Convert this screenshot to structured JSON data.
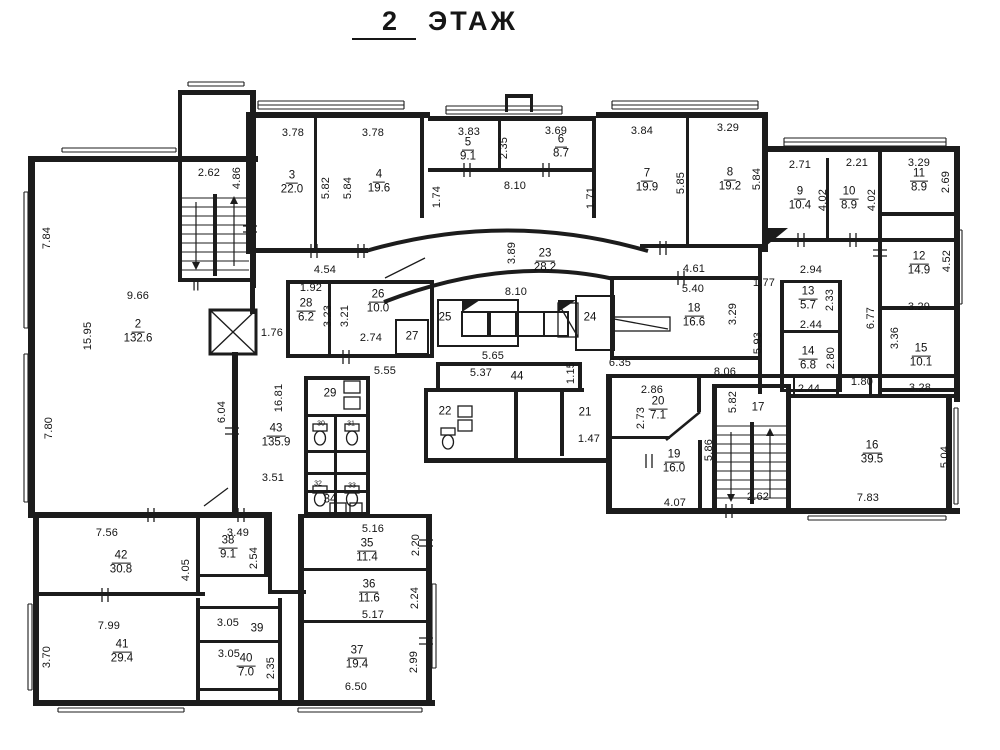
{
  "title": {
    "number": "2",
    "word": "ЭТАЖ"
  },
  "colors": {
    "ink": "#1c1c1c",
    "paper": "#ffffff"
  },
  "stair_mark": {
    "t": "II",
    "x": 196,
    "y": 286
  },
  "rooms": [
    {
      "n": "2",
      "a": "132.6",
      "x": 138,
      "y": 332
    },
    {
      "n": "3",
      "a": "22.0",
      "x": 292,
      "y": 183
    },
    {
      "n": "4",
      "a": "19.6",
      "x": 379,
      "y": 182
    },
    {
      "n": "5",
      "a": "9.1",
      "x": 468,
      "y": 150
    },
    {
      "n": "6",
      "a": "8.7",
      "x": 561,
      "y": 147
    },
    {
      "n": "7",
      "a": "19.9",
      "x": 647,
      "y": 181
    },
    {
      "n": "8",
      "a": "19.2",
      "x": 730,
      "y": 180
    },
    {
      "n": "9",
      "a": "10.4",
      "x": 800,
      "y": 199
    },
    {
      "n": "10",
      "a": "8.9",
      "x": 849,
      "y": 199
    },
    {
      "n": "11",
      "a": "8.9",
      "x": 919,
      "y": 181
    },
    {
      "n": "12",
      "a": "14.9",
      "x": 919,
      "y": 264
    },
    {
      "n": "13",
      "a": "5.7",
      "x": 808,
      "y": 299
    },
    {
      "n": "14",
      "a": "6.8",
      "x": 808,
      "y": 359
    },
    {
      "n": "15",
      "a": "10.1",
      "x": 921,
      "y": 356
    },
    {
      "n": "16",
      "a": "39.5",
      "x": 872,
      "y": 453
    },
    {
      "n": "17",
      "x": 758,
      "y": 408
    },
    {
      "n": "18",
      "a": "16.6",
      "x": 694,
      "y": 316
    },
    {
      "n": "19",
      "a": "16.0",
      "x": 674,
      "y": 462
    },
    {
      "n": "20",
      "a": "7.1",
      "x": 658,
      "y": 409
    },
    {
      "n": "21",
      "x": 585,
      "y": 413
    },
    {
      "n": "22",
      "x": 445,
      "y": 412
    },
    {
      "n": "23",
      "a": "28.2",
      "x": 545,
      "y": 261
    },
    {
      "n": "24",
      "x": 590,
      "y": 318
    },
    {
      "n": "25",
      "x": 445,
      "y": 318
    },
    {
      "n": "26",
      "a": "10.0",
      "x": 378,
      "y": 302
    },
    {
      "n": "27",
      "x": 412,
      "y": 337
    },
    {
      "n": "28",
      "a": "6.2",
      "x": 306,
      "y": 311
    },
    {
      "n": "29",
      "x": 330,
      "y": 394
    },
    {
      "n": "30",
      "x": 321,
      "y": 424,
      "tiny": 1
    },
    {
      "n": "31",
      "x": 351,
      "y": 424,
      "tiny": 1
    },
    {
      "n": "32",
      "x": 318,
      "y": 484,
      "tiny": 1
    },
    {
      "n": "33",
      "x": 352,
      "y": 486,
      "tiny": 1
    },
    {
      "n": "34",
      "x": 330,
      "y": 500
    },
    {
      "n": "35",
      "a": "11.4",
      "x": 367,
      "y": 551
    },
    {
      "n": "36",
      "a": "11.6",
      "x": 369,
      "y": 592
    },
    {
      "n": "37",
      "a": "19.4",
      "x": 357,
      "y": 658
    },
    {
      "n": "38",
      "a": "9.1",
      "x": 228,
      "y": 548
    },
    {
      "n": "39",
      "x": 257,
      "y": 629
    },
    {
      "n": "40",
      "a": "7.0",
      "x": 246,
      "y": 666
    },
    {
      "n": "41",
      "a": "29.4",
      "x": 122,
      "y": 652
    },
    {
      "n": "42",
      "a": "30.8",
      "x": 121,
      "y": 563
    },
    {
      "n": "43",
      "a": "135.9",
      "x": 276,
      "y": 436
    },
    {
      "n": "44",
      "x": 517,
      "y": 377
    }
  ],
  "dimensions": [
    {
      "t": "2.62",
      "x": 209,
      "y": 173
    },
    {
      "t": "4.86",
      "x": 237,
      "y": 178,
      "v": 1
    },
    {
      "t": "3.78",
      "x": 293,
      "y": 133
    },
    {
      "t": "3.78",
      "x": 373,
      "y": 133
    },
    {
      "t": "5.82",
      "x": 326,
      "y": 188,
      "v": 1
    },
    {
      "t": "5.84",
      "x": 348,
      "y": 188,
      "v": 1
    },
    {
      "t": "3.83",
      "x": 469,
      "y": 132
    },
    {
      "t": "2.35",
      "x": 504,
      "y": 148,
      "v": 1
    },
    {
      "t": "3.69",
      "x": 556,
      "y": 131
    },
    {
      "t": "1.74",
      "x": 437,
      "y": 197,
      "v": 1
    },
    {
      "t": "8.10",
      "x": 515,
      "y": 186
    },
    {
      "t": "1.71",
      "x": 591,
      "y": 198,
      "v": 1
    },
    {
      "t": "3.84",
      "x": 642,
      "y": 131
    },
    {
      "t": "5.85",
      "x": 681,
      "y": 183,
      "v": 1
    },
    {
      "t": "3.29",
      "x": 728,
      "y": 128
    },
    {
      "t": "5.84",
      "x": 757,
      "y": 179,
      "v": 1
    },
    {
      "t": "2.71",
      "x": 800,
      "y": 165
    },
    {
      "t": "4.02",
      "x": 823,
      "y": 200,
      "v": 1
    },
    {
      "t": "2.21",
      "x": 857,
      "y": 163
    },
    {
      "t": "4.02",
      "x": 872,
      "y": 200,
      "v": 1
    },
    {
      "t": "3.29",
      "x": 919,
      "y": 163
    },
    {
      "t": "2.69",
      "x": 946,
      "y": 182,
      "v": 1
    },
    {
      "t": "7.84",
      "x": 47,
      "y": 238,
      "v": 1
    },
    {
      "t": "9.66",
      "x": 138,
      "y": 296
    },
    {
      "t": "15.95",
      "x": 88,
      "y": 336,
      "v": 1
    },
    {
      "t": "7.80",
      "x": 49,
      "y": 428,
      "v": 1
    },
    {
      "t": "1.76",
      "x": 272,
      "y": 333
    },
    {
      "t": "6.04",
      "x": 222,
      "y": 412,
      "v": 1
    },
    {
      "t": "4.54",
      "x": 325,
      "y": 270
    },
    {
      "t": "1.92",
      "x": 311,
      "y": 288
    },
    {
      "t": "3.23",
      "x": 328,
      "y": 316,
      "v": 1
    },
    {
      "t": "3.21",
      "x": 345,
      "y": 316,
      "v": 1
    },
    {
      "t": "2.74",
      "x": 371,
      "y": 338
    },
    {
      "t": "3.89",
      "x": 512,
      "y": 253,
      "v": 1
    },
    {
      "t": "8.10",
      "x": 516,
      "y": 292
    },
    {
      "t": "5.65",
      "x": 493,
      "y": 356
    },
    {
      "t": "4.61",
      "x": 694,
      "y": 269
    },
    {
      "t": "5.40",
      "x": 693,
      "y": 289
    },
    {
      "t": "3.29",
      "x": 733,
      "y": 314,
      "v": 1
    },
    {
      "t": "1.77",
      "x": 764,
      "y": 283
    },
    {
      "t": "5.93",
      "x": 758,
      "y": 343,
      "v": 1
    },
    {
      "t": "6.35",
      "x": 620,
      "y": 363
    },
    {
      "t": "8.06",
      "x": 725,
      "y": 372
    },
    {
      "t": "2.94",
      "x": 811,
      "y": 270
    },
    {
      "t": "2.33",
      "x": 830,
      "y": 300,
      "v": 1
    },
    {
      "t": "2.44",
      "x": 811,
      "y": 325
    },
    {
      "t": "6.77",
      "x": 871,
      "y": 318,
      "v": 1
    },
    {
      "t": "3.29",
      "x": 919,
      "y": 307
    },
    {
      "t": "2.80",
      "x": 831,
      "y": 358,
      "v": 1
    },
    {
      "t": "2.44",
      "x": 809,
      "y": 389
    },
    {
      "t": "1.80",
      "x": 862,
      "y": 382
    },
    {
      "t": "3.36",
      "x": 895,
      "y": 338,
      "v": 1
    },
    {
      "t": "3.28",
      "x": 920,
      "y": 388
    },
    {
      "t": "4.52",
      "x": 947,
      "y": 261,
      "v": 1
    },
    {
      "t": "16.81",
      "x": 279,
      "y": 398,
      "v": 1
    },
    {
      "t": "3.51",
      "x": 273,
      "y": 478
    },
    {
      "t": "5.55",
      "x": 385,
      "y": 371
    },
    {
      "t": "5.37",
      "x": 481,
      "y": 373
    },
    {
      "t": "1.15",
      "x": 571,
      "y": 373,
      "v": 1
    },
    {
      "t": "2.86",
      "x": 652,
      "y": 390
    },
    {
      "t": "2.73",
      "x": 641,
      "y": 418,
      "v": 1
    },
    {
      "t": "1.47",
      "x": 589,
      "y": 439
    },
    {
      "t": "5.82",
      "x": 733,
      "y": 402,
      "v": 1
    },
    {
      "t": "5.86",
      "x": 709,
      "y": 450,
      "v": 1
    },
    {
      "t": "4.07",
      "x": 675,
      "y": 503
    },
    {
      "t": "2.62",
      "x": 758,
      "y": 497
    },
    {
      "t": "5.04",
      "x": 945,
      "y": 457,
      "v": 1
    },
    {
      "t": "7.83",
      "x": 868,
      "y": 498
    },
    {
      "t": "7.56",
      "x": 107,
      "y": 533
    },
    {
      "t": "4.05",
      "x": 186,
      "y": 570,
      "v": 1
    },
    {
      "t": "3.49",
      "x": 238,
      "y": 533
    },
    {
      "t": "2.54",
      "x": 254,
      "y": 558,
      "v": 1
    },
    {
      "t": "7.99",
      "x": 109,
      "y": 626
    },
    {
      "t": "3.70",
      "x": 47,
      "y": 657,
      "v": 1
    },
    {
      "t": "3.05",
      "x": 228,
      "y": 623
    },
    {
      "t": "3.05",
      "x": 229,
      "y": 654
    },
    {
      "t": "2.35",
      "x": 271,
      "y": 668,
      "v": 1
    },
    {
      "t": "6.50",
      "x": 356,
      "y": 687
    },
    {
      "t": "5.16",
      "x": 373,
      "y": 529
    },
    {
      "t": "2.20",
      "x": 416,
      "y": 545,
      "v": 1
    },
    {
      "t": "2.24",
      "x": 415,
      "y": 598,
      "v": 1
    },
    {
      "t": "5.17",
      "x": 373,
      "y": 615
    },
    {
      "t": "2.99",
      "x": 414,
      "y": 662,
      "v": 1
    }
  ]
}
